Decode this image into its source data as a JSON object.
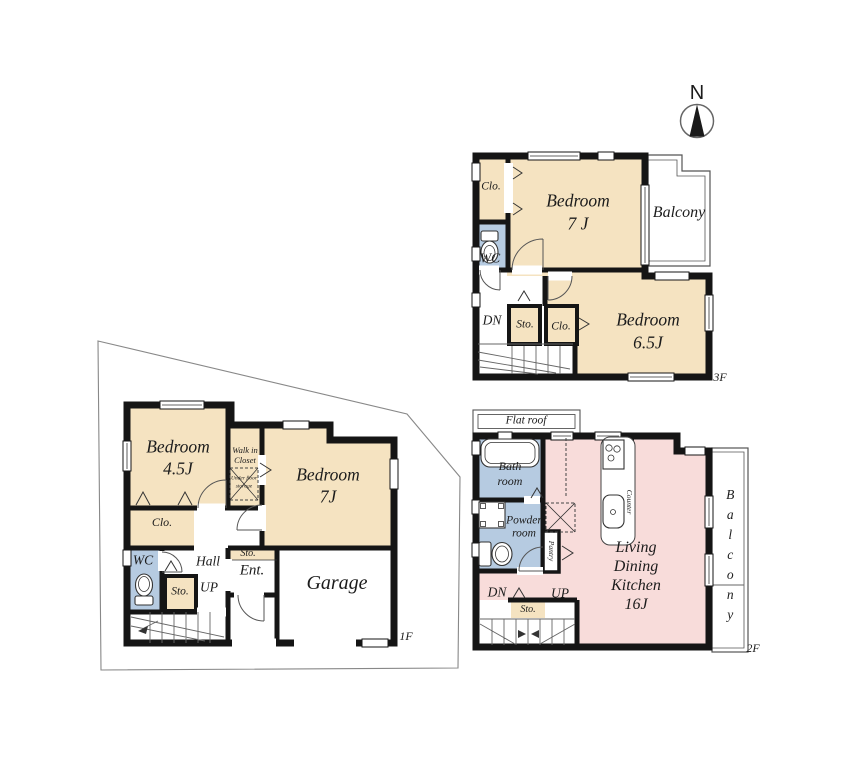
{
  "compass": {
    "north_label": "N"
  },
  "colors": {
    "room_tan": "#F5E3C1",
    "wet_area_blue": "#B6CBE1",
    "ldk_pink": "#F8DCDA",
    "wall_black": "#151515"
  },
  "floor3": {
    "floor_label": "3F",
    "closet_top": "Clo.",
    "bedroom7": {
      "name": "Bedroom",
      "size": "7 J"
    },
    "balcony": "Balcony",
    "wc": "WC",
    "down": "DN",
    "storage": "Sto.",
    "closet_bottom": "Clo.",
    "bedroom65": {
      "name": "Bedroom",
      "size": "6.5J"
    }
  },
  "floor1": {
    "floor_label": "1F",
    "bedroom45": {
      "name": "Bedroom",
      "size": "4.5J"
    },
    "walk_in_closet": {
      "line1": "Walk in",
      "line2": "Closet",
      "underfloor_line1": "Under floor",
      "underfloor_line2": "storage"
    },
    "bedroom7": {
      "name": "Bedroom",
      "size": "7J"
    },
    "closet": "Clo.",
    "wc": "WC",
    "hall": "Hall",
    "up": "UP",
    "storage_hall": "Sto.",
    "storage_entrance": "Sto.",
    "entrance": "Ent.",
    "garage": "Garage"
  },
  "floor2": {
    "floor_label": "2F",
    "flat_roof": "Flat roof",
    "bath_room": {
      "line1": "Bath",
      "line2": "room"
    },
    "powder_room": {
      "line1": "Powder",
      "line2": "room"
    },
    "pantry": "Pantry",
    "counter": "Counter",
    "ldk": {
      "line1": "Living",
      "line2": "Dining",
      "line3": "Kitchen",
      "size": "16J"
    },
    "down": "DN",
    "up": "UP",
    "storage": "Sto.",
    "balcony": "Balcony"
  }
}
